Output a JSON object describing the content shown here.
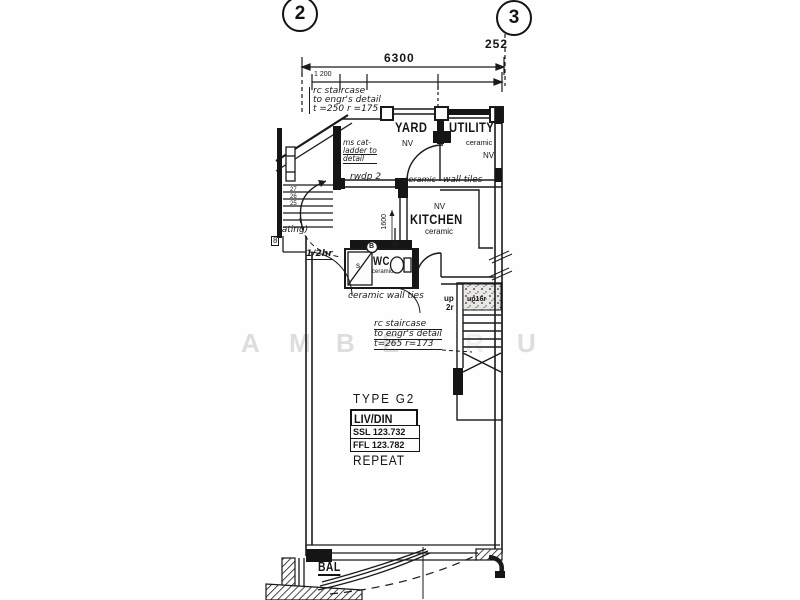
{
  "grid": {
    "left_bubble": "2",
    "right_bubble": "3"
  },
  "dims": {
    "overall": "6300",
    "partial_right": "252",
    "sub": "1 200",
    "kitchen_v": "1600"
  },
  "stairs": {
    "up2r_l1": "up",
    "up2r_l2": "2r",
    "up16r": "up16r",
    "treads": [
      "27",
      "26",
      "25"
    ]
  },
  "notes": {
    "top_note": {
      "l1": "rc staircase",
      "l2": "to engr's detail",
      "l3": "t =250  r =175"
    },
    "center_note": {
      "l1": "rc staircase",
      "l2": "to engr's detail",
      "l3": "t=265  r=173"
    },
    "cat_ladder": {
      "l1": "ms cat-",
      "l2": "ladder to",
      "l3": "detail"
    },
    "rwdp": "rwdp 2",
    "rating_partial": "rating)",
    "eight_partial": "8",
    "fire_rating": "1/2hr",
    "wc_tiles": "ceramic wall ties",
    "kitchen_tiles_1": "ceramic",
    "kitchen_tiles_2": "wall tiles"
  },
  "rooms": {
    "yard": {
      "name": "YARD",
      "vent": "NV"
    },
    "utility": {
      "name": "UTILITY",
      "finish": "ceramic",
      "vent": "NV"
    },
    "kitchen": {
      "vent": "NV",
      "name": "KITCHEN",
      "finish": "ceramic"
    },
    "wc": {
      "name": "WC",
      "finish": "ceramic",
      "shower": "s",
      "fixture": "B"
    },
    "balcony": {
      "name": "BAL"
    }
  },
  "unit": {
    "type": "TYPE G2",
    "room": "LIV/DIN",
    "ssl": "SSL 123.732",
    "ffl": "FFL 123.782",
    "repeat": "REPEAT"
  },
  "watermark": [
    "A",
    "M",
    "B",
    "E",
    "R",
    "U"
  ]
}
